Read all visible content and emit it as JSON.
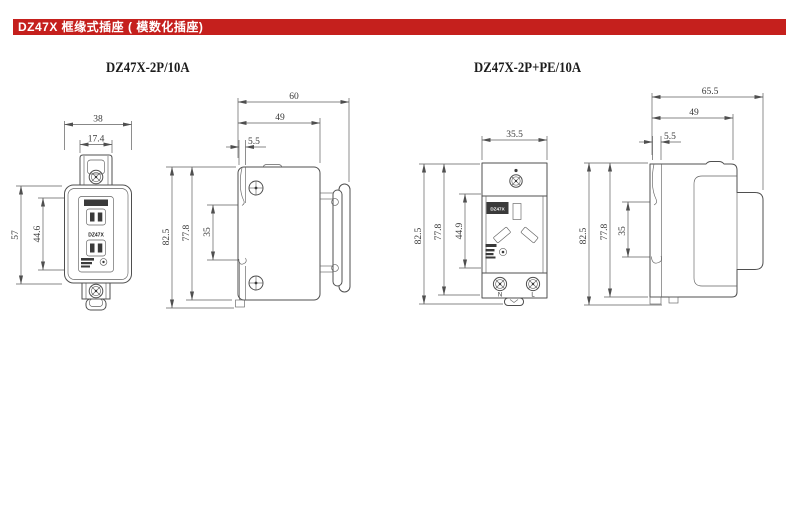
{
  "header": {
    "title": "DZ47X 框缘式插座 ( 模数化插座)",
    "bg_color": "#c5201d",
    "text_color": "#ffffff"
  },
  "figures": {
    "left": {
      "title": "DZ47X-2P/10A",
      "front": {
        "face_label": "DZ47X",
        "width_outer": "38",
        "width_inner": "17.4",
        "height_outer": "57",
        "height_inner": "44.6"
      },
      "side": {
        "depth_outer": "60",
        "depth_body": "49",
        "rail_thickness": "5.5",
        "height_outer": "82.5",
        "height_body": "77.8",
        "rail_span": "35"
      }
    },
    "right": {
      "title": "DZ47X-2P+PE/10A",
      "front": {
        "face_label": "DZ47X",
        "width_outer": "35.5",
        "height_outer": "82.5",
        "height_body": "77.8",
        "height_inner": "44.9",
        "terminal_left": "N",
        "terminal_right": "L"
      },
      "side": {
        "depth_outer": "65.5",
        "depth_body": "49",
        "rail_thickness": "5.5",
        "height_outer": "82.5",
        "height_body": "77.8",
        "rail_span": "35"
      }
    }
  }
}
